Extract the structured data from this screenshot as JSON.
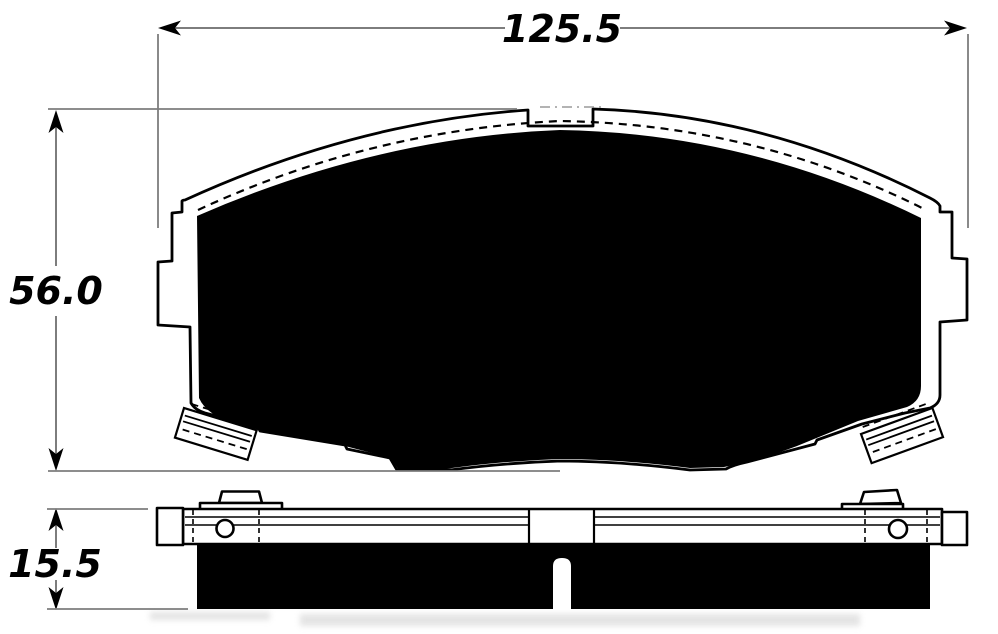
{
  "dimensions": {
    "width_mm": "125.5",
    "height_mm": "56.0",
    "thickness_mm": "15.5"
  }
}
